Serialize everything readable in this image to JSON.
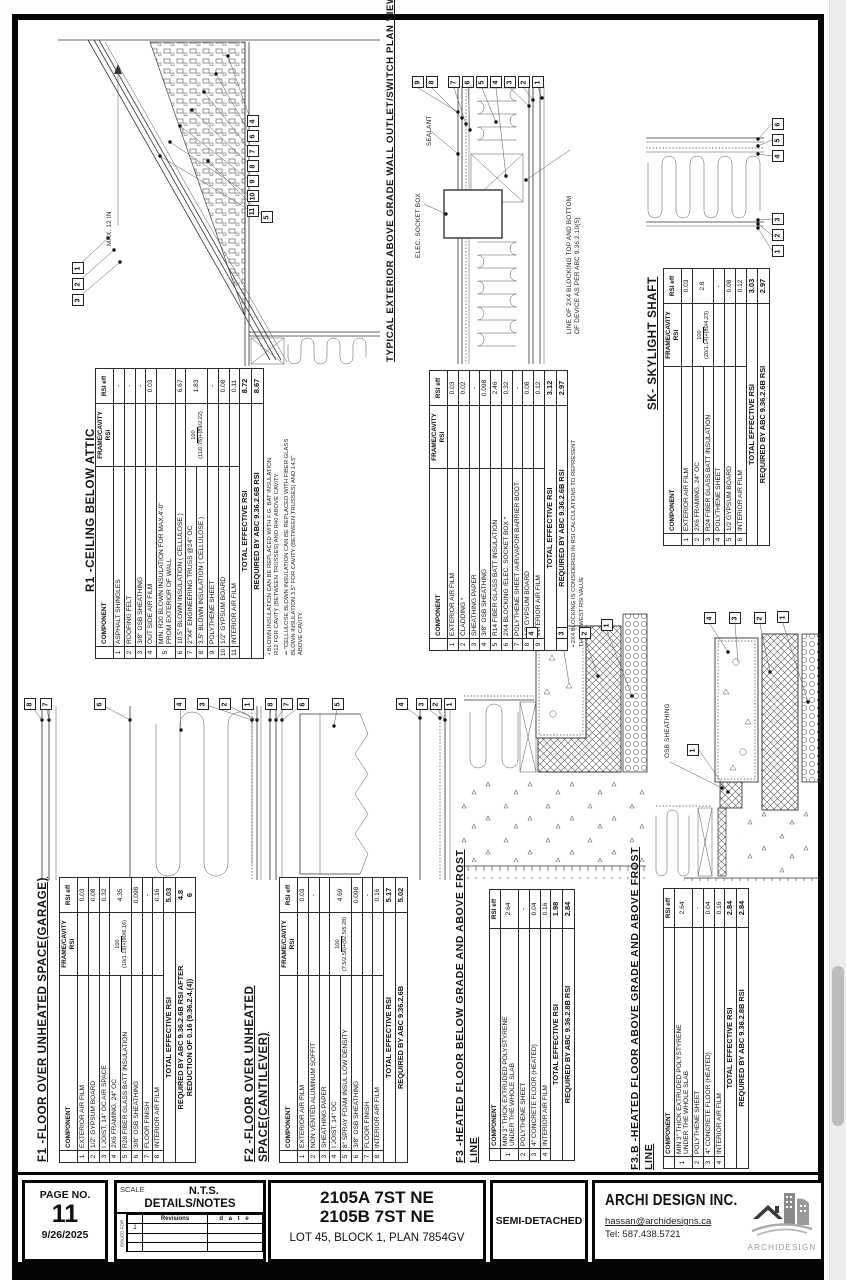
{
  "tables": {
    "r1": {
      "title": "R1 -CEILING BELOW ATTIC",
      "headers": [
        "",
        "COMPONENT",
        "FRAME/CAVITY RSI",
        "RSI eff"
      ],
      "rows": [
        [
          "1",
          "ASPHALT SHINGLES",
          "",
          "-"
        ],
        [
          "2",
          "ROOFING FELT",
          "",
          "-"
        ],
        [
          "3",
          "3/8\" OSB SHEATHING",
          "",
          "-"
        ],
        [
          "4",
          "OUT SIDE AIR FILM",
          "",
          "0.03"
        ],
        [
          "5",
          "MIN. R20 BLOWN INSULATION FOR MAX.4'-0\"\nFROM EXTERIOR OF WALL",
          "",
          ""
        ],
        [
          "6",
          "10.5\" BLOWN INSULATION ( CELLULOSE )",
          "",
          "6.67"
        ],
        [
          "7",
          "2\"X4\" ENGINEERING TRUSS @24\" OC",
          "100|(11/0.76)+(89/2.22)",
          "1.83"
        ],
        [
          "8",
          "3.5\" BLOWN INSULATION ( CELLULOSE )",
          "^",
          "^"
        ],
        [
          "9",
          "POLYTHENE SHEET",
          "",
          "-"
        ],
        [
          "10",
          "1/2\" GYPSUM BOARD",
          "",
          "0.08"
        ],
        [
          "11",
          "INTERIOR AIR FILM",
          "",
          "0.11"
        ]
      ],
      "footers": [
        [
          "TOTAL  EFFECTIVE   RSI",
          "8.72"
        ],
        [
          "REQUIRED BY ABC 9.36.2.6B   RSI",
          "8.67"
        ]
      ],
      "notes": [
        "•   BLOWN INSULATION CAN BE REPLACED WITH F.G. BAT INSULATION\n     R12 FOR CAVITY (BETWEEN TRUSSES) AND R40 ABOVE CAVITY.",
        "••  \"CELLULOSE BLOWN INSULATION CAN BE REPLACED WITH FIBER GLASS\n     BLOWN INSULATION 3.5\" FOR CAVITY (BETWEEN TRUSSES) AND 14.5\"\n     ABOVE CAVITY."
      ]
    },
    "wall": {
      "title": "TYPICAL EXTERIOR ABOVE GRADE WALL OUTLET/SWITCH PLAN VIEW",
      "headers": [
        "",
        "COMPONENT",
        "FRAME/CAVITY RSI",
        "RSI eff"
      ],
      "rows": [
        [
          "1",
          "EXTERIOR AIR FILM",
          "",
          "0.03"
        ],
        [
          "2",
          "CLADDING *",
          "",
          "0.02"
        ],
        [
          "3",
          "SHEATHING PAPER",
          "",
          "-"
        ],
        [
          "4",
          "3/8\" OSB SHEATHING",
          "",
          "0.098"
        ],
        [
          "5",
          "R14 FIBER GLASS BATT INSULATION",
          "",
          "2.46"
        ],
        [
          "6",
          "2X4  BLOCKING /ELEC. SOCKET BOX *",
          "",
          "0.32"
        ],
        [
          "7",
          "POLYTHENE SHEET /AIR/VAPOR BARRIER BOOT",
          "",
          "-"
        ],
        [
          "8",
          "1/2 GYPSUM BOARD",
          "",
          "0.08"
        ],
        [
          "9",
          "INTERIOR AIR FILM",
          "",
          "0.12"
        ]
      ],
      "footers": [
        [
          "TOTAL  EFFECTIVE   RSI",
          "3.12"
        ],
        [
          "REQUIRED BY ABC 9.36.2.6B   RSI",
          "2.97"
        ]
      ],
      "notes": [
        "•  2X4  BLOCKING IS CONSIDERED IN RSI CALCULATIONS TO REPRESENT\n    THE LOWEST RSI VALUE"
      ]
    },
    "sk": {
      "title": "SK- SKYLIGHT SHAFT",
      "headers": [
        "",
        "COMPONENT",
        "FRAME/CAVITY RSI",
        "RSI eff"
      ],
      "rows": [
        [
          "1",
          "EXTERIOR AIR FILM",
          "",
          "0.03"
        ],
        [
          "2",
          "2X6 FRAMING, 24\" OC",
          "100|(20/1.14)+(80/4.23)",
          "2.8"
        ],
        [
          "3",
          "R24 FIBER GLASS BATT INSULATION",
          "^",
          "^"
        ],
        [
          "4",
          "POLYTHENE SHEET",
          "",
          "-"
        ],
        [
          "5",
          "1/2 GYPSUM BOARD",
          "",
          "0.08"
        ],
        [
          "6",
          "INTERIOR AIR FILM",
          "",
          "0.12"
        ]
      ],
      "footers": [
        [
          "TOTAL  EFFECTIVE   RSI",
          "3.03"
        ],
        [
          "REQUIRED BY ABC 9.36.2.6B   RSI",
          "2.97"
        ]
      ],
      "notes": []
    },
    "f1": {
      "title": "F1 -FLOOR OVER UNHEATED SPACE(GARAGE)",
      "headers": [
        "",
        "COMPONENT",
        "FRAME/CAVITY RSI",
        "RSI eff"
      ],
      "rows": [
        [
          "1",
          "EXTERIOR AIR FILM",
          "",
          "0.03"
        ],
        [
          "2",
          "1/2\" GYPSUM BOARD",
          "",
          "0.08"
        ],
        [
          "3",
          "I JOIST, 14\" OC  AIR SPACE",
          "",
          "0.32"
        ],
        [
          "4",
          "2X6 FRAMING, 24\" OC",
          "100|(10/1.19)+(90/6.16)",
          "4.35"
        ],
        [
          "5",
          "R28 FIBER GLASS BATT INSULATION",
          "^",
          "^"
        ],
        [
          "6",
          "3/8\" OSB SHEATHING",
          "",
          "0.098"
        ],
        [
          "7",
          "FLOOR FINISH",
          "",
          "-"
        ],
        [
          "8",
          "INTERIOR AIR FILM",
          "",
          "0.16"
        ]
      ],
      "footers": [
        [
          "TOTAL  EFFECTIVE   RSI",
          "5.03"
        ],
        [
          "REQUIRED BY ABC 9.36.2.6B  RSI AFTER\nREDUCTION OF 0.16 (9.36.2.4.(4))",
          "4.8\n6"
        ]
      ],
      "notes": []
    },
    "f2": {
      "title": "F2 -FLOOR OVER UNHEATED\nSPACE(CANTILEVER)",
      "headers": [
        "",
        "COMPONENT",
        "FRAME/CAVITY RSI",
        "RSI eff"
      ],
      "rows": [
        [
          "1",
          "EXTERIOR AIR FILM",
          "",
          "0.03"
        ],
        [
          "2",
          "NON VENTED  ALUMINUM SOFFIT",
          "",
          "-"
        ],
        [
          "3",
          "SHEATHING PAPER",
          "",
          ""
        ],
        [
          "4",
          "I JOIST, 14\" OC",
          "100|(7.5/2.56)+(92.5/5.28)",
          "4.69"
        ],
        [
          "5",
          "8\" SPRAY FOAM INSUL LOW DENSITY",
          "^",
          "^"
        ],
        [
          "6",
          "3/8\" OSB SHEATHING",
          "",
          "0.098"
        ],
        [
          "7",
          "FLOOR FINISH",
          "",
          "-"
        ],
        [
          "8",
          "INTERIOR AIR FILM",
          "",
          "0.16"
        ]
      ],
      "footers": [
        [
          "TOTAL  EFFECTIVE   RSI",
          "5.17"
        ],
        [
          "REQUIRED BY ABC 9.36.2.6B",
          "5.02"
        ]
      ],
      "notes": []
    },
    "f3": {
      "title": "F3 -HEATED FLOOR BELOW GRADE AND ABOVE FROST\nLINE",
      "headers": [
        "",
        "COMPONENT",
        "RSI eff"
      ],
      "rows": [
        [
          "1",
          "MIN 3\" THICK EXTRUDED  POLYSTYRENE\nUNDER THE WHOLE SLAB",
          "2.64"
        ],
        [
          "2",
          "POLYTHENE SHEET",
          "-"
        ],
        [
          "3",
          "4\" CONCRETE FLOOR  (HEATED)",
          "0.04"
        ],
        [
          "4",
          "INTERIOR AIR FILM",
          "0.16"
        ]
      ],
      "footers": [
        [
          "TOTAL  EFFECTIVE   RSI",
          "1.98"
        ],
        [
          "REQUIRED BY ABC 9.36.2.8B   RSI",
          "2.84"
        ]
      ],
      "notes": []
    },
    "f3b": {
      "title": "F3.B -HEATED FLOOR ABOVE GRADE AND ABOVE FROST\nLINE",
      "headers": [
        "",
        "COMPONENT",
        "RSI eff"
      ],
      "rows": [
        [
          "1",
          "MIN 3\" THICK EXTRUDED  POLYSTYRENE\nUNDER THE WHOLE SLAB",
          "2.64"
        ],
        [
          "2",
          "POLYTHENE SHEET",
          "-"
        ],
        [
          "3",
          "4\" CONCRETE FLOOR (HEATED)",
          "0.04"
        ],
        [
          "4",
          "INTERIOR AIR FILM",
          "0.16"
        ]
      ],
      "footers": [
        [
          "TOTAL  EFFECTIVE   RSI",
          "2.84"
        ],
        [
          "REQUIRED BY ABC 9.36.2.8B   RSI",
          "2.84"
        ]
      ],
      "notes": []
    }
  },
  "drawings": {
    "roof": {
      "max_label": "MAX. 12 IN",
      "callouts_right": [
        "4",
        "6",
        "7",
        "8",
        "9",
        "10",
        "11"
      ],
      "callout_five": [
        "5"
      ],
      "callouts_left": [
        "1",
        "2",
        "3"
      ]
    },
    "wall": {
      "sealant": "SEALANT",
      "socket": "ELEC. SOCKET BOX",
      "blocking_note": "LINE OF 2X4 BLOCKING TOP AND BOTTOM\nOF DEVICE AS PER ABC 9.36.2.10(5)",
      "callouts_top": [
        "9",
        "8",
        "7",
        "6",
        "5",
        "4",
        "3",
        "2",
        "1"
      ]
    },
    "sk": {
      "callouts_top": [
        "6",
        "5",
        "4"
      ],
      "callouts_bottom": [
        "3",
        "2",
        "1"
      ]
    },
    "f1": {
      "callouts": [
        "8",
        "7",
        "6",
        "4",
        "3",
        "2",
        "1"
      ]
    },
    "f2": {
      "callouts": [
        "8",
        "7",
        "6",
        "5",
        "4",
        "3",
        "2",
        "1"
      ]
    },
    "f3": {
      "callouts": [
        "4",
        "3",
        "2",
        "1"
      ]
    },
    "f3b": {
      "osb_label": "OSB SHEATHING",
      "callouts_top": [
        "4",
        "3",
        "2",
        "1"
      ],
      "callout_lone": [
        "1"
      ]
    }
  },
  "titleblock": {
    "page_label": "PAGE NO.",
    "page_no": "11",
    "date": "9/26/2025",
    "scale_label": "SCALE",
    "scale_value": "N.T.S.",
    "sheet_name": "DETAILS/NOTES",
    "issued_for": "ISSUED FOR",
    "revisions_label": "Revisions",
    "date_label": "d a t e",
    "rev_row_1": "1",
    "address_line1": "2105A 7ST NE",
    "address_line2": "2105B 7ST NE",
    "address_line3": "LOT 45, BLOCK 1, PLAN 7854GV",
    "building_type": "SEMI-DETACHED",
    "company": "ARCHI DESIGN INC.",
    "email": "hassan@archidesigns.ca",
    "tel": "Tel: 587.438.5721",
    "logo_text": "ARCHIDESIGN"
  }
}
